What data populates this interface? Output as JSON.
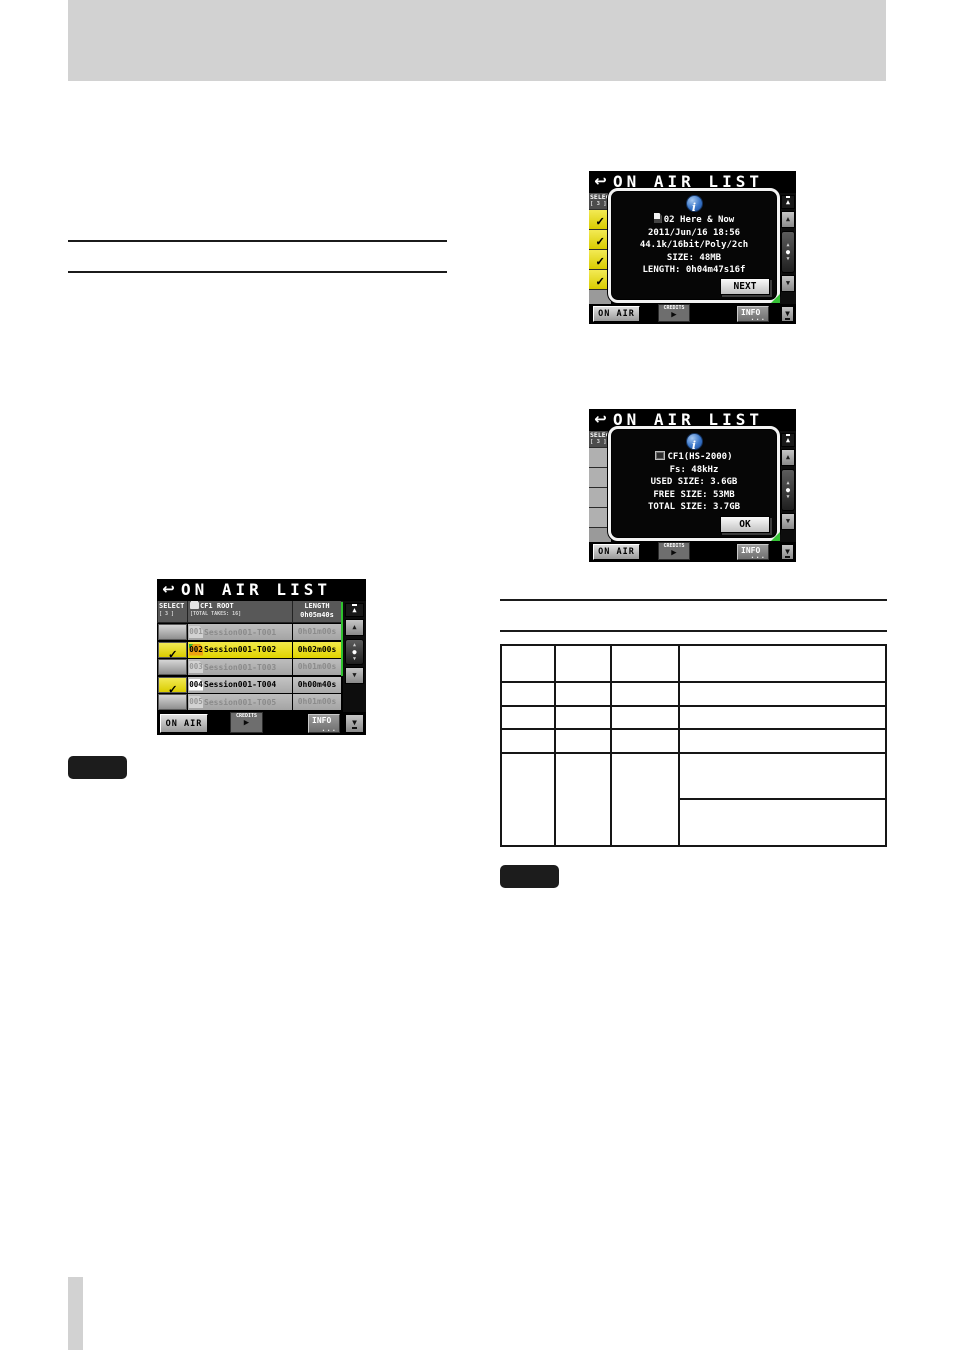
{
  "colors": {
    "page_gray": "#d2d2d2",
    "select_yellow": "#e8dc00",
    "current_take_orange": "#eda211",
    "scrollbar_green": "#2ec32e",
    "info_blue": "#3a76c8",
    "screen_black": "#000000"
  },
  "icons": {
    "return": "↩",
    "check": "✓",
    "play": "▶",
    "up": "▲",
    "down": "▼",
    "dot": "●",
    "info_i": "i"
  },
  "footer": {
    "on_air": "ON AIR",
    "credits": "CREDITS",
    "info": "INFO",
    "dots": "..."
  },
  "screens": {
    "take_info": {
      "title": "ON AIR LIST",
      "popup": {
        "name": "02 Here & Now",
        "date": "2011/Jun/16 18:56",
        "format": "44.1k/16bit/Poly/2ch",
        "size": "SIZE: 48MB",
        "length": "LENGTH: 0h04m47s16f",
        "button": "NEXT"
      }
    },
    "media_info": {
      "title": "ON AIR LIST",
      "popup": {
        "name": "CF1(HS-2000)",
        "fs": "Fs: 48kHz",
        "used": "USED SIZE: 3.6GB",
        "free": "FREE SIZE: 53MB",
        "total": "TOTAL SIZE: 3.7GB",
        "button": "OK"
      }
    },
    "list": {
      "title": "ON AIR LIST",
      "columns": {
        "select": "SELECT",
        "select_count": "[ 3 ]",
        "folder": "CF1 ROOT",
        "folder_sub": "[TOTAL TAKES: 16]",
        "length": "LENGTH",
        "length_total": "0h05m40s"
      },
      "rows": [
        {
          "num": "001",
          "name": "Session001-T001",
          "length": "0h01m00s",
          "checked": false
        },
        {
          "num": "002",
          "name": "Session001-T002",
          "length": "0h02m00s",
          "checked": true
        },
        {
          "num": "003",
          "name": "Session001-T003",
          "length": "0h01m00s",
          "checked": false
        },
        {
          "num": "004",
          "name": "Session001-T004",
          "length": "0h00m40s",
          "checked": true
        },
        {
          "num": "005",
          "name": "Session001-T005",
          "length": "0h01m00s",
          "checked": false
        }
      ]
    }
  }
}
